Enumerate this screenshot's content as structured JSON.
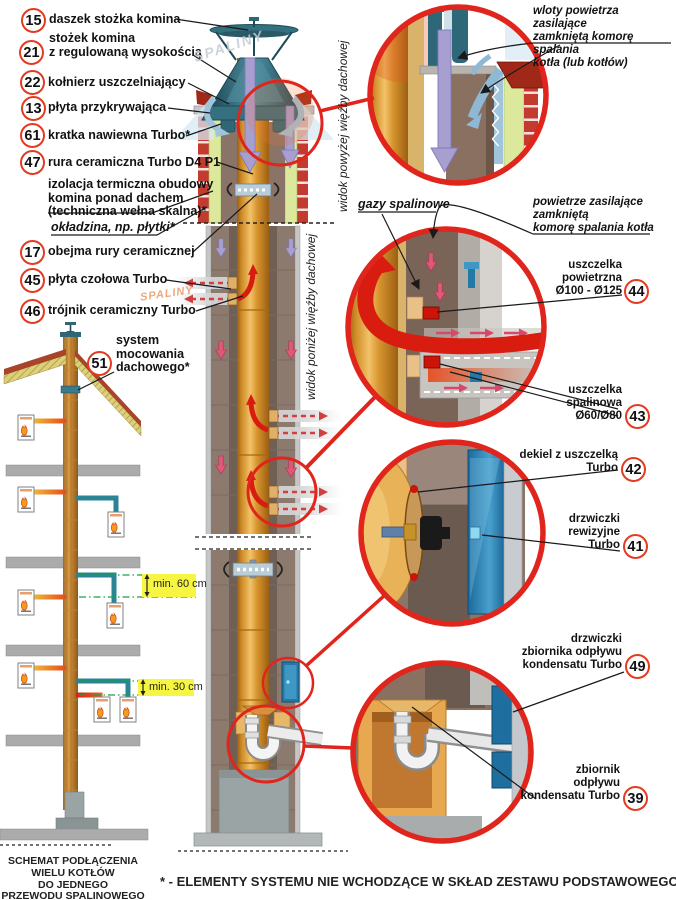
{
  "callouts": {
    "c15": {
      "num": "15",
      "label": "daszek stożka komina"
    },
    "c21": {
      "num": "21",
      "label": "stożek komina\nz regulowaną wysokością"
    },
    "c22": {
      "num": "22",
      "label": "kołnierz uszczelniający"
    },
    "c13": {
      "num": "13",
      "label": "płyta przykrywająca"
    },
    "c61": {
      "num": "61",
      "label": "kratka nawiewna Turbo*"
    },
    "c47": {
      "num": "47",
      "label": "rura ceramiczna Turbo D4 P1"
    },
    "c17": {
      "num": "17",
      "label": "obejma rury ceramicznej"
    },
    "c45": {
      "num": "45",
      "label": "płyta czołowa Turbo"
    },
    "c46": {
      "num": "46",
      "label": "trójnik ceramiczny Turbo"
    },
    "c51": {
      "num": "51",
      "label": "system\nmocowania\ndachowego*"
    },
    "c44": {
      "num": "44",
      "label": "uszczelka\npowietrzna\nØ100 - Ø125"
    },
    "c43": {
      "num": "43",
      "label": "uszczelka\nspalinowa\nØ60/Ø80"
    },
    "c42": {
      "num": "42",
      "label": "dekiel z uszczelką\nTurbo"
    },
    "c41": {
      "num": "41",
      "label": "drzwiczki\nrewizyjne\nTurbo"
    },
    "c49": {
      "num": "49",
      "label": "drzwiczki\nzbiornika odpływu\nkondensatu Turbo"
    },
    "c39": {
      "num": "39",
      "label": "zbiornik\nodpływu\nkondensatu Turbo"
    }
  },
  "notes": {
    "insulation": "izolacja termiczna obudowy\nkomina ponad dachem\n(techniczna wełna skalna)*",
    "cladding": "okładzina, np. płytki*"
  },
  "annotations": {
    "air_inlets": "wloty powietrza zasilające\nzamkniętą komorę spalania\nkotła (lub kotłów)",
    "flue_gases": "gazy spalinowe",
    "air_supply": "powietrze zasilające\nzamkniętą\nkomorę spalania kotła",
    "view_above_roof": "widok powyżej więźby dachowej",
    "view_below_roof": "widok poniżej więźby dachowej",
    "min_60": "min. 60 cm",
    "min_30": "min. 30 cm",
    "watermark_flue": "SPALINY"
  },
  "footer": {
    "schematic_caption": "SCHEMAT PODŁĄCZENIA\nWIELU KOTŁÓW\nDO JEDNEGO\nPRZEWODU SPALINOWEGO",
    "asterisk_note": "* - ELEMENTY SYSTEMU NIE WCHODZĄCE W SKŁAD ZESTAWU PODSTAWOWEGO"
  },
  "colors": {
    "callout_ring": "#e23b22",
    "detail_ring": "#e0251c",
    "ceramic_pipe": "#d8922e",
    "casing_brown": "#8d7a6e",
    "insulation_green": "#dce89c",
    "clinker_red": "#c23b2e",
    "cap_teal": "#2e6878",
    "air_purple": "#a79fd0",
    "air_blue": "#9fc4dc",
    "flue_red": "#d81c10",
    "pipe_teal": "#2a8494",
    "door_blue": "#2478a8",
    "min_label_bg": "#f5f542"
  }
}
